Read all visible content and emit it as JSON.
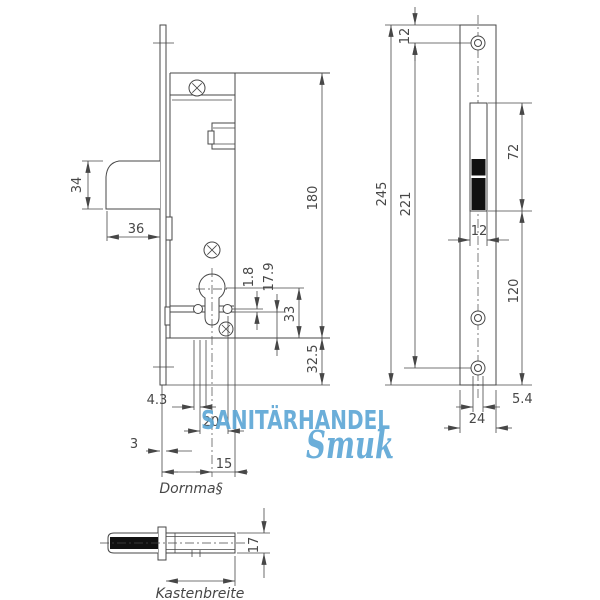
{
  "watermark": {
    "line1": "SANITÄRHANDEL",
    "line2": "Smuk",
    "color": "#5fa8d6"
  },
  "labels": {
    "dornmass": "Dornma§",
    "kastenbreite": "Kastenbreite"
  },
  "dimensions": {
    "bolt_height": "34",
    "bolt_length": "36",
    "case_length": "180",
    "bar_gap": "1.8",
    "follower_to_bottom": "17.9",
    "cylinder_to_bottom": "33",
    "bottom_extension": "32.5",
    "hole_gap": "4.3",
    "nub_spacing": "20",
    "plate_thickness": "3",
    "center_to_edge": "15",
    "plate_top_to_hole": "12",
    "plate_length": "245",
    "hole_spacing": "221",
    "cutout_height": "72",
    "cutout_width": "12",
    "cutout_to_bottom": "120",
    "hole_diameter": "5.4",
    "plate_width": "24",
    "case_depth": "17"
  },
  "colors": {
    "line": "#474747",
    "bolt_fill": "#111111"
  }
}
